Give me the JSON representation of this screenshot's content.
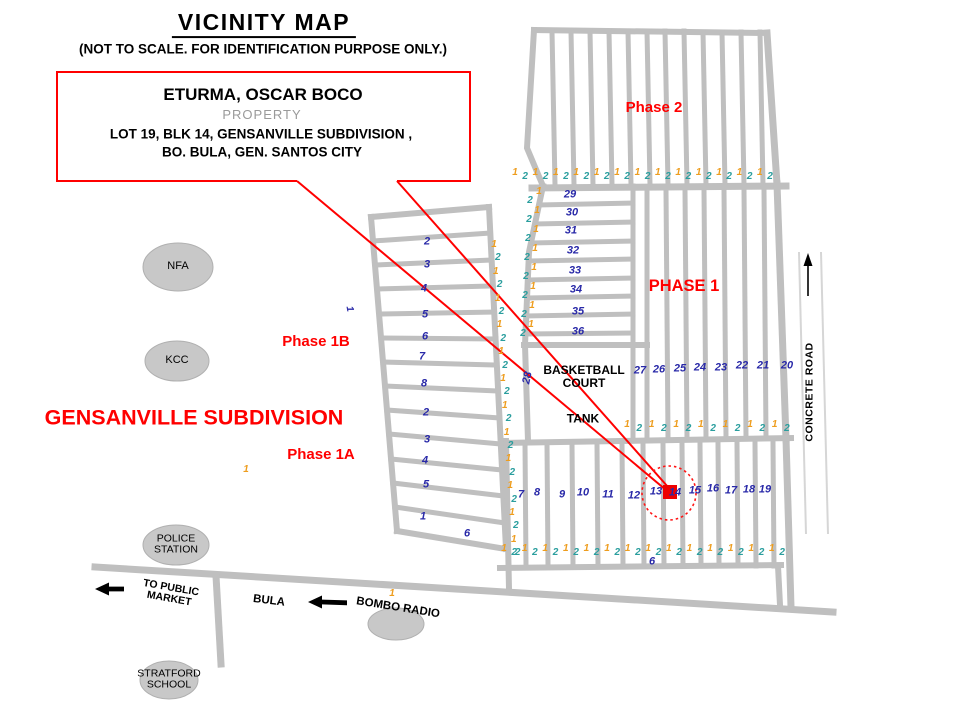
{
  "title": "VICINITY MAP",
  "subtitle": "(NOT TO SCALE. FOR IDENTIFICATION PURPOSE ONLY.)",
  "property_box": {
    "owner": "ETURMA, OSCAR BOCO",
    "type": "PROPERTY",
    "address1": "LOT 19, BLK 14, GENSANVILLE SUBDIVISION ,",
    "address2": "BO. BULA,  GEN. SANTOS CITY"
  },
  "areas": {
    "phase2": "Phase 2",
    "phase1": "PHASE 1",
    "phase1b": "Phase 1B",
    "phase1a": "Phase 1A",
    "subdivision": "GENSANVILLE SUBDIVISION"
  },
  "places": {
    "nfa": "NFA",
    "kcc": "KCC",
    "police_l1": "POLICE",
    "police_l2": "STATION",
    "stratford_l1": "STRATFORD",
    "stratford_l2": "SCHOOL",
    "bombo": "BOMBO RADIO",
    "bula": "BULA",
    "market_l1": "TO PUBLIC",
    "market_l2": "MARKET",
    "basketball_l1": "BASKETBALL",
    "basketball_l2": "COURT",
    "tank": "TANK",
    "concrete_road": "CONCRETE ROAD"
  },
  "colors": {
    "orange": "#EE9D1E",
    "teal": "#2A9E9E",
    "navy": "#2929A8",
    "red": "#FF0000",
    "road": "#BFBFBF"
  },
  "marks": [
    {
      "t": "29",
      "x": 570,
      "y": 195,
      "c": "navy",
      "fs": 11
    },
    {
      "t": "30",
      "x": 572,
      "y": 213,
      "c": "navy",
      "fs": 11
    },
    {
      "t": "31",
      "x": 571,
      "y": 231,
      "c": "navy",
      "fs": 11
    },
    {
      "t": "32",
      "x": 573,
      "y": 251,
      "c": "navy",
      "fs": 11
    },
    {
      "t": "33",
      "x": 575,
      "y": 271,
      "c": "navy",
      "fs": 11
    },
    {
      "t": "34",
      "x": 576,
      "y": 290,
      "c": "navy",
      "fs": 11
    },
    {
      "t": "35",
      "x": 578,
      "y": 312,
      "c": "navy",
      "fs": 11
    },
    {
      "t": "36",
      "x": 578,
      "y": 332,
      "c": "navy",
      "fs": 11
    },
    {
      "t": "27",
      "x": 640,
      "y": 371,
      "c": "navy",
      "fs": 11
    },
    {
      "t": "26",
      "x": 659,
      "y": 370,
      "c": "navy",
      "fs": 11
    },
    {
      "t": "25",
      "x": 680,
      "y": 369,
      "c": "navy",
      "fs": 11
    },
    {
      "t": "24",
      "x": 700,
      "y": 368,
      "c": "navy",
      "fs": 11
    },
    {
      "t": "23",
      "x": 721,
      "y": 368,
      "c": "navy",
      "fs": 11
    },
    {
      "t": "22",
      "x": 742,
      "y": 366,
      "c": "navy",
      "fs": 11
    },
    {
      "t": "21",
      "x": 763,
      "y": 366,
      "c": "navy",
      "fs": 11
    },
    {
      "t": "20",
      "x": 787,
      "y": 366,
      "c": "navy",
      "fs": 11
    },
    {
      "t": "7",
      "x": 521,
      "y": 495,
      "c": "navy",
      "fs": 11
    },
    {
      "t": "8",
      "x": 537,
      "y": 493,
      "c": "navy",
      "fs": 11
    },
    {
      "t": "9",
      "x": 562,
      "y": 495,
      "c": "navy",
      "fs": 11
    },
    {
      "t": "10",
      "x": 583,
      "y": 493,
      "c": "navy",
      "fs": 11
    },
    {
      "t": "11",
      "x": 608,
      "y": 495,
      "c": "navy",
      "fs": 11
    },
    {
      "t": "12",
      "x": 634,
      "y": 496,
      "c": "navy",
      "fs": 11
    },
    {
      "t": "13",
      "x": 656,
      "y": 492,
      "c": "navy",
      "fs": 11
    },
    {
      "t": "14",
      "x": 675,
      "y": 493,
      "c": "navy",
      "fs": 11
    },
    {
      "t": "15",
      "x": 695,
      "y": 491,
      "c": "navy",
      "fs": 11
    },
    {
      "t": "16",
      "x": 713,
      "y": 489,
      "c": "navy",
      "fs": 11
    },
    {
      "t": "17",
      "x": 731,
      "y": 491,
      "c": "navy",
      "fs": 11
    },
    {
      "t": "18",
      "x": 749,
      "y": 490,
      "c": "navy",
      "fs": 11
    },
    {
      "t": "19",
      "x": 765,
      "y": 490,
      "c": "navy",
      "fs": 11
    },
    {
      "t": "2",
      "x": 427,
      "y": 242,
      "c": "navy",
      "fs": 11
    },
    {
      "t": "3",
      "x": 427,
      "y": 265,
      "c": "navy",
      "fs": 11
    },
    {
      "t": "4",
      "x": 424,
      "y": 289,
      "c": "navy",
      "fs": 11
    },
    {
      "t": "5",
      "x": 425,
      "y": 315,
      "c": "navy",
      "fs": 11
    },
    {
      "t": "6",
      "x": 425,
      "y": 337,
      "c": "navy",
      "fs": 11
    },
    {
      "t": "7",
      "x": 422,
      "y": 357,
      "c": "navy",
      "fs": 11
    },
    {
      "t": "8",
      "x": 424,
      "y": 384,
      "c": "navy",
      "fs": 11
    },
    {
      "t": "2",
      "x": 426,
      "y": 413,
      "c": "navy",
      "fs": 11
    },
    {
      "t": "3",
      "x": 427,
      "y": 440,
      "c": "navy",
      "fs": 11
    },
    {
      "t": "4",
      "x": 425,
      "y": 461,
      "c": "navy",
      "fs": 11
    },
    {
      "t": "5",
      "x": 426,
      "y": 485,
      "c": "navy",
      "fs": 11
    },
    {
      "t": "1",
      "x": 423,
      "y": 517,
      "c": "navy",
      "fs": 11
    },
    {
      "t": "6",
      "x": 467,
      "y": 534,
      "c": "navy",
      "fs": 11
    },
    {
      "t": "6",
      "x": 652,
      "y": 562,
      "c": "navy",
      "fs": 11
    },
    {
      "t": "28",
      "x": 528,
      "y": 378,
      "c": "navy",
      "fs": 11,
      "r": -78
    },
    {
      "t": "1",
      "x": 349,
      "y": 309,
      "c": "navy",
      "fs": 10,
      "r": 80
    },
    {
      "t": "1",
      "x": 246,
      "y": 470,
      "c": "orange",
      "fs": 10
    },
    {
      "t": "1",
      "x": 392,
      "y": 594,
      "c": "orange",
      "fs": 10
    },
    {
      "t": "1",
      "x": 539,
      "y": 192,
      "c": "orange",
      "fs": 10
    },
    {
      "t": "1",
      "x": 537,
      "y": 211,
      "c": "orange",
      "fs": 10
    },
    {
      "t": "1",
      "x": 536,
      "y": 230,
      "c": "orange",
      "fs": 10
    },
    {
      "t": "1",
      "x": 535,
      "y": 249,
      "c": "orange",
      "fs": 10
    },
    {
      "t": "1",
      "x": 534,
      "y": 268,
      "c": "orange",
      "fs": 10
    },
    {
      "t": "1",
      "x": 533,
      "y": 287,
      "c": "orange",
      "fs": 10
    },
    {
      "t": "1",
      "x": 532,
      "y": 306,
      "c": "orange",
      "fs": 10
    },
    {
      "t": "1",
      "x": 531,
      "y": 325,
      "c": "orange",
      "fs": 10
    },
    {
      "t": "2",
      "x": 530,
      "y": 201,
      "c": "teal",
      "fs": 10
    },
    {
      "t": "2",
      "x": 529,
      "y": 220,
      "c": "teal",
      "fs": 10
    },
    {
      "t": "2",
      "x": 528,
      "y": 239,
      "c": "teal",
      "fs": 10
    },
    {
      "t": "2",
      "x": 527,
      "y": 258,
      "c": "teal",
      "fs": 10
    },
    {
      "t": "2",
      "x": 526,
      "y": 277,
      "c": "teal",
      "fs": 10
    },
    {
      "t": "2",
      "x": 525,
      "y": 296,
      "c": "teal",
      "fs": 10
    },
    {
      "t": "2",
      "x": 524,
      "y": 315,
      "c": "teal",
      "fs": 10
    },
    {
      "t": "2",
      "x": 523,
      "y": 334,
      "c": "teal",
      "fs": 10
    }
  ],
  "sequences": [
    {
      "name": "phase2-frontage",
      "x0": 515,
      "y0": 173,
      "dx": 10.2,
      "dy": 0,
      "count": 26,
      "jy": 4,
      "pattern": [
        "1",
        "2"
      ]
    },
    {
      "name": "mid-frontage",
      "x0": 627,
      "y0": 425,
      "dx": 12.3,
      "dy": 0,
      "count": 14,
      "jy": 4,
      "pattern": [
        "1",
        "2"
      ]
    },
    {
      "name": "lower-frontage",
      "x0": 504,
      "y0": 549,
      "dx": 10.3,
      "dy": 0,
      "count": 28,
      "jy": 4,
      "pattern": [
        "1",
        "2"
      ]
    },
    {
      "name": "west-block-frontage",
      "x0": 494,
      "y0": 245,
      "dx": 0.9,
      "dy": 13.4,
      "count": 24,
      "jx": 3,
      "pattern": [
        "1",
        "2"
      ]
    }
  ]
}
